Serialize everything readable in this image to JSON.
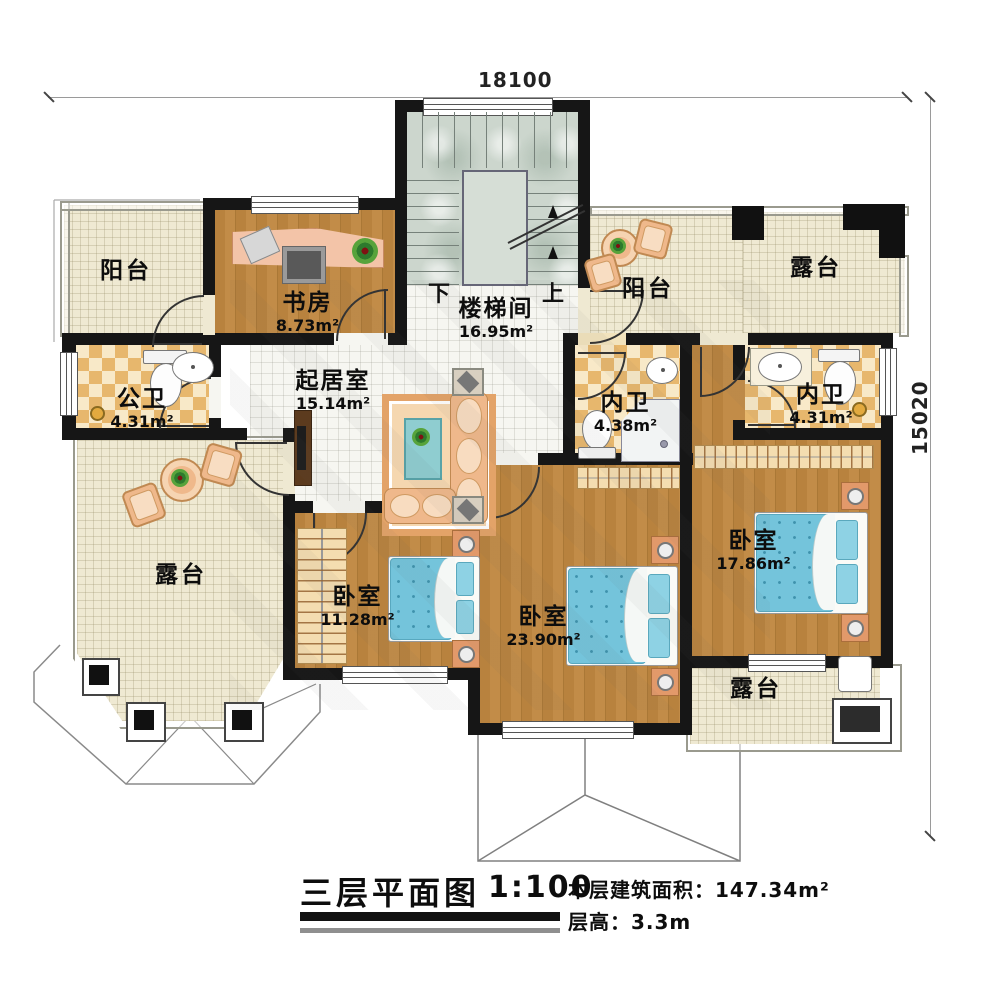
{
  "dimensions": {
    "top": "18100",
    "right": "15020"
  },
  "stairs": {
    "down": "下",
    "up": "上"
  },
  "rooms": {
    "balcony_left": {
      "name": "阳台"
    },
    "study": {
      "name": "书房",
      "area": "8.73m²"
    },
    "stairwell": {
      "name": "楼梯间",
      "area": "16.95m²"
    },
    "balcony_right": {
      "name": "阳台"
    },
    "terrace_top": {
      "name": "露台"
    },
    "bath_public": {
      "name": "公卫",
      "area": "4.31m²"
    },
    "living": {
      "name": "起居室",
      "area": "15.14m²"
    },
    "bath_suite1": {
      "name": "内卫",
      "area": "4.38m²"
    },
    "bath_suite2": {
      "name": "内卫",
      "area": "4.31m²"
    },
    "terrace_left": {
      "name": "露台"
    },
    "bedroom_small": {
      "name": "卧室",
      "area": "11.28m²"
    },
    "bedroom_big": {
      "name": "卧室",
      "area": "23.90m²"
    },
    "bedroom_right": {
      "name": "卧室",
      "area": "17.86m²"
    },
    "terrace_bottom": {
      "name": "露台"
    }
  },
  "title": {
    "name": "三层平面图",
    "scale": "1:100",
    "floor_area": "本层建筑面积：147.34m²",
    "floor_height": "层高：3.3m"
  },
  "colors": {
    "wall": "#161616",
    "wood_floor": "#b8823e",
    "terrace_tile": "#efe9d2",
    "bath_tile": "#e7b76d",
    "stair_stone": "#ccd6cd",
    "bed_blue": "#74c4db",
    "furniture_peach": "#efb88b"
  }
}
